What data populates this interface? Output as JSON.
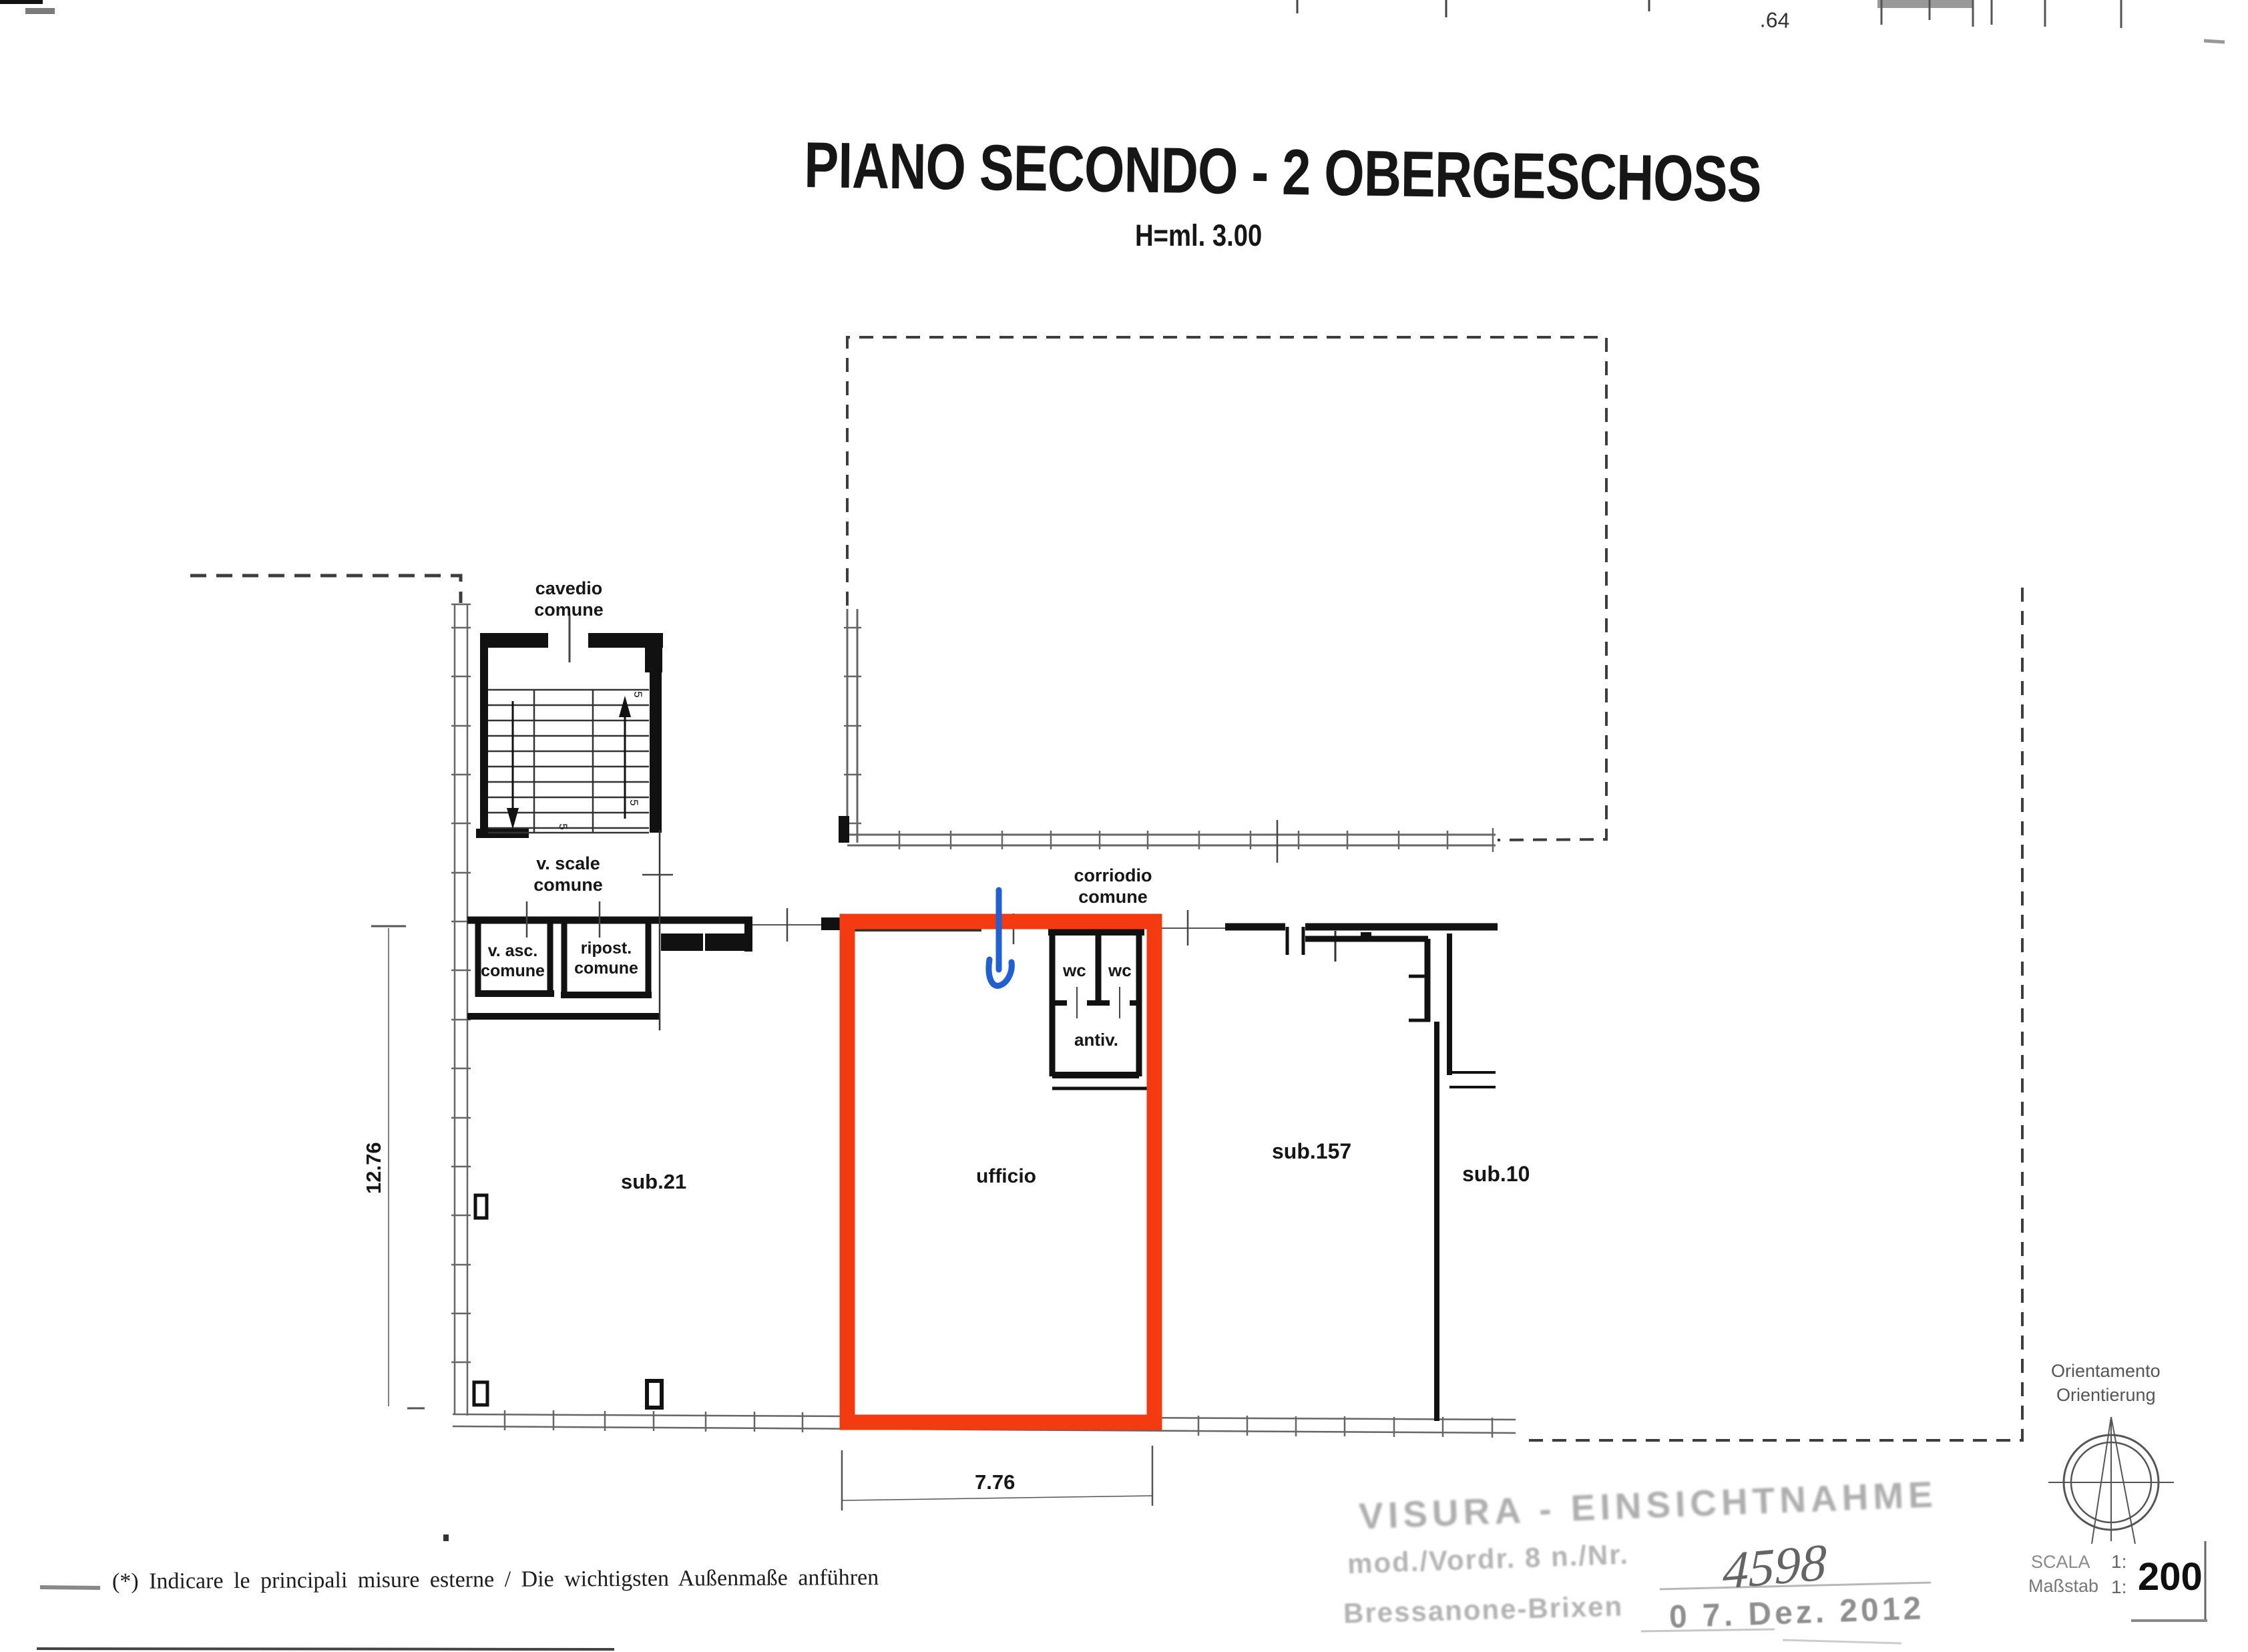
{
  "title": {
    "line1": "PIANO SECONDO - 2 OBERGESCHOSS",
    "line2": "H=ml. 3.00"
  },
  "top_edge": {
    "fragment_label": ".64"
  },
  "labels": {
    "cavedio_line1": "cavedio",
    "cavedio_line2": "comune",
    "v_scale_line1": "v. scale",
    "v_scale_line2": "comune",
    "v_asc_line1": "v. asc.",
    "v_asc_line2": "comune",
    "ripost_line1": "ripost.",
    "ripost_line2": "comune",
    "corridoio_line1": "corriodio",
    "corridoio_line2": "comune",
    "wc": "wc",
    "antiv": "antiv.",
    "sub21": "sub.21",
    "ufficio": "ufficio",
    "sub157": "sub.157",
    "sub10": "sub.10"
  },
  "dimensions": {
    "left_height": "12.76",
    "bottom_width": "7.76",
    "stair_mark": "5"
  },
  "footnote": "(*) Indicare le principali misure esterne / Die wichtigsten Außenmaße anführen",
  "stamp": {
    "line1": "VISURA - EINSICHTNAHME",
    "line2": "mod./Vordr. 8 n./Nr.",
    "number": "4598",
    "line3": "Bressanone-Brixen",
    "date": "0 7. Dez. 2012"
  },
  "orientation": {
    "line1": "Orientamento",
    "line2": "Orientierung"
  },
  "scale_block": {
    "scala_label": "SCALA",
    "massstab_label": "Maßstab",
    "ratio_prefix": "1:",
    "value": "200"
  },
  "colors": {
    "highlight_red": "#f43a10",
    "annotation_blue": "#2060d0"
  }
}
